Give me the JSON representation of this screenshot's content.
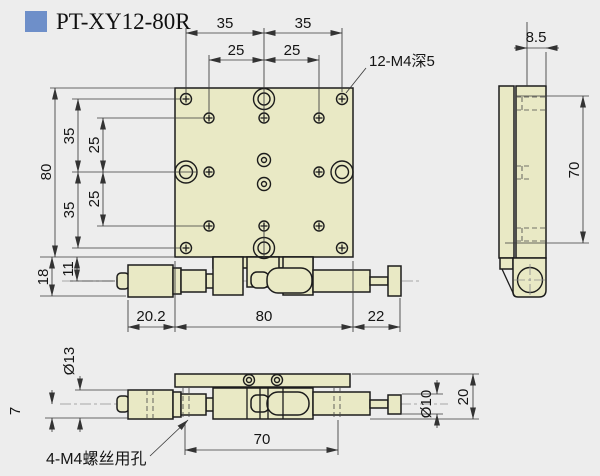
{
  "title": "PT-XY12-80R",
  "colors": {
    "background": "#ededed",
    "accent": "#6e8fc9",
    "part_fill": "#e9e9c5",
    "line": "#1c1c1c",
    "dim": "#3a3a3a"
  },
  "callouts": {
    "top_plate_holes": "12-M4深5",
    "base_mount_holes": "4-M4螺丝用孔"
  },
  "front_view": {
    "top": {
      "d35_left": "35",
      "d35_right": "35",
      "d25_left": "25",
      "d25_right": "25"
    },
    "left": {
      "d80": "80",
      "d35_upper": "35",
      "d25_upper": "25",
      "d25_lower": "25",
      "d35_lower": "35",
      "d18": "18",
      "d11": "11"
    },
    "bottom": {
      "d20_2": "20.2",
      "d80": "80",
      "d22": "22"
    }
  },
  "side_view": {
    "d8_5": "8.5",
    "d70": "70"
  },
  "bottom_view": {
    "d13": "Ø13",
    "d7": "7",
    "d70": "70",
    "d10": "Ø10",
    "d20": "20"
  }
}
